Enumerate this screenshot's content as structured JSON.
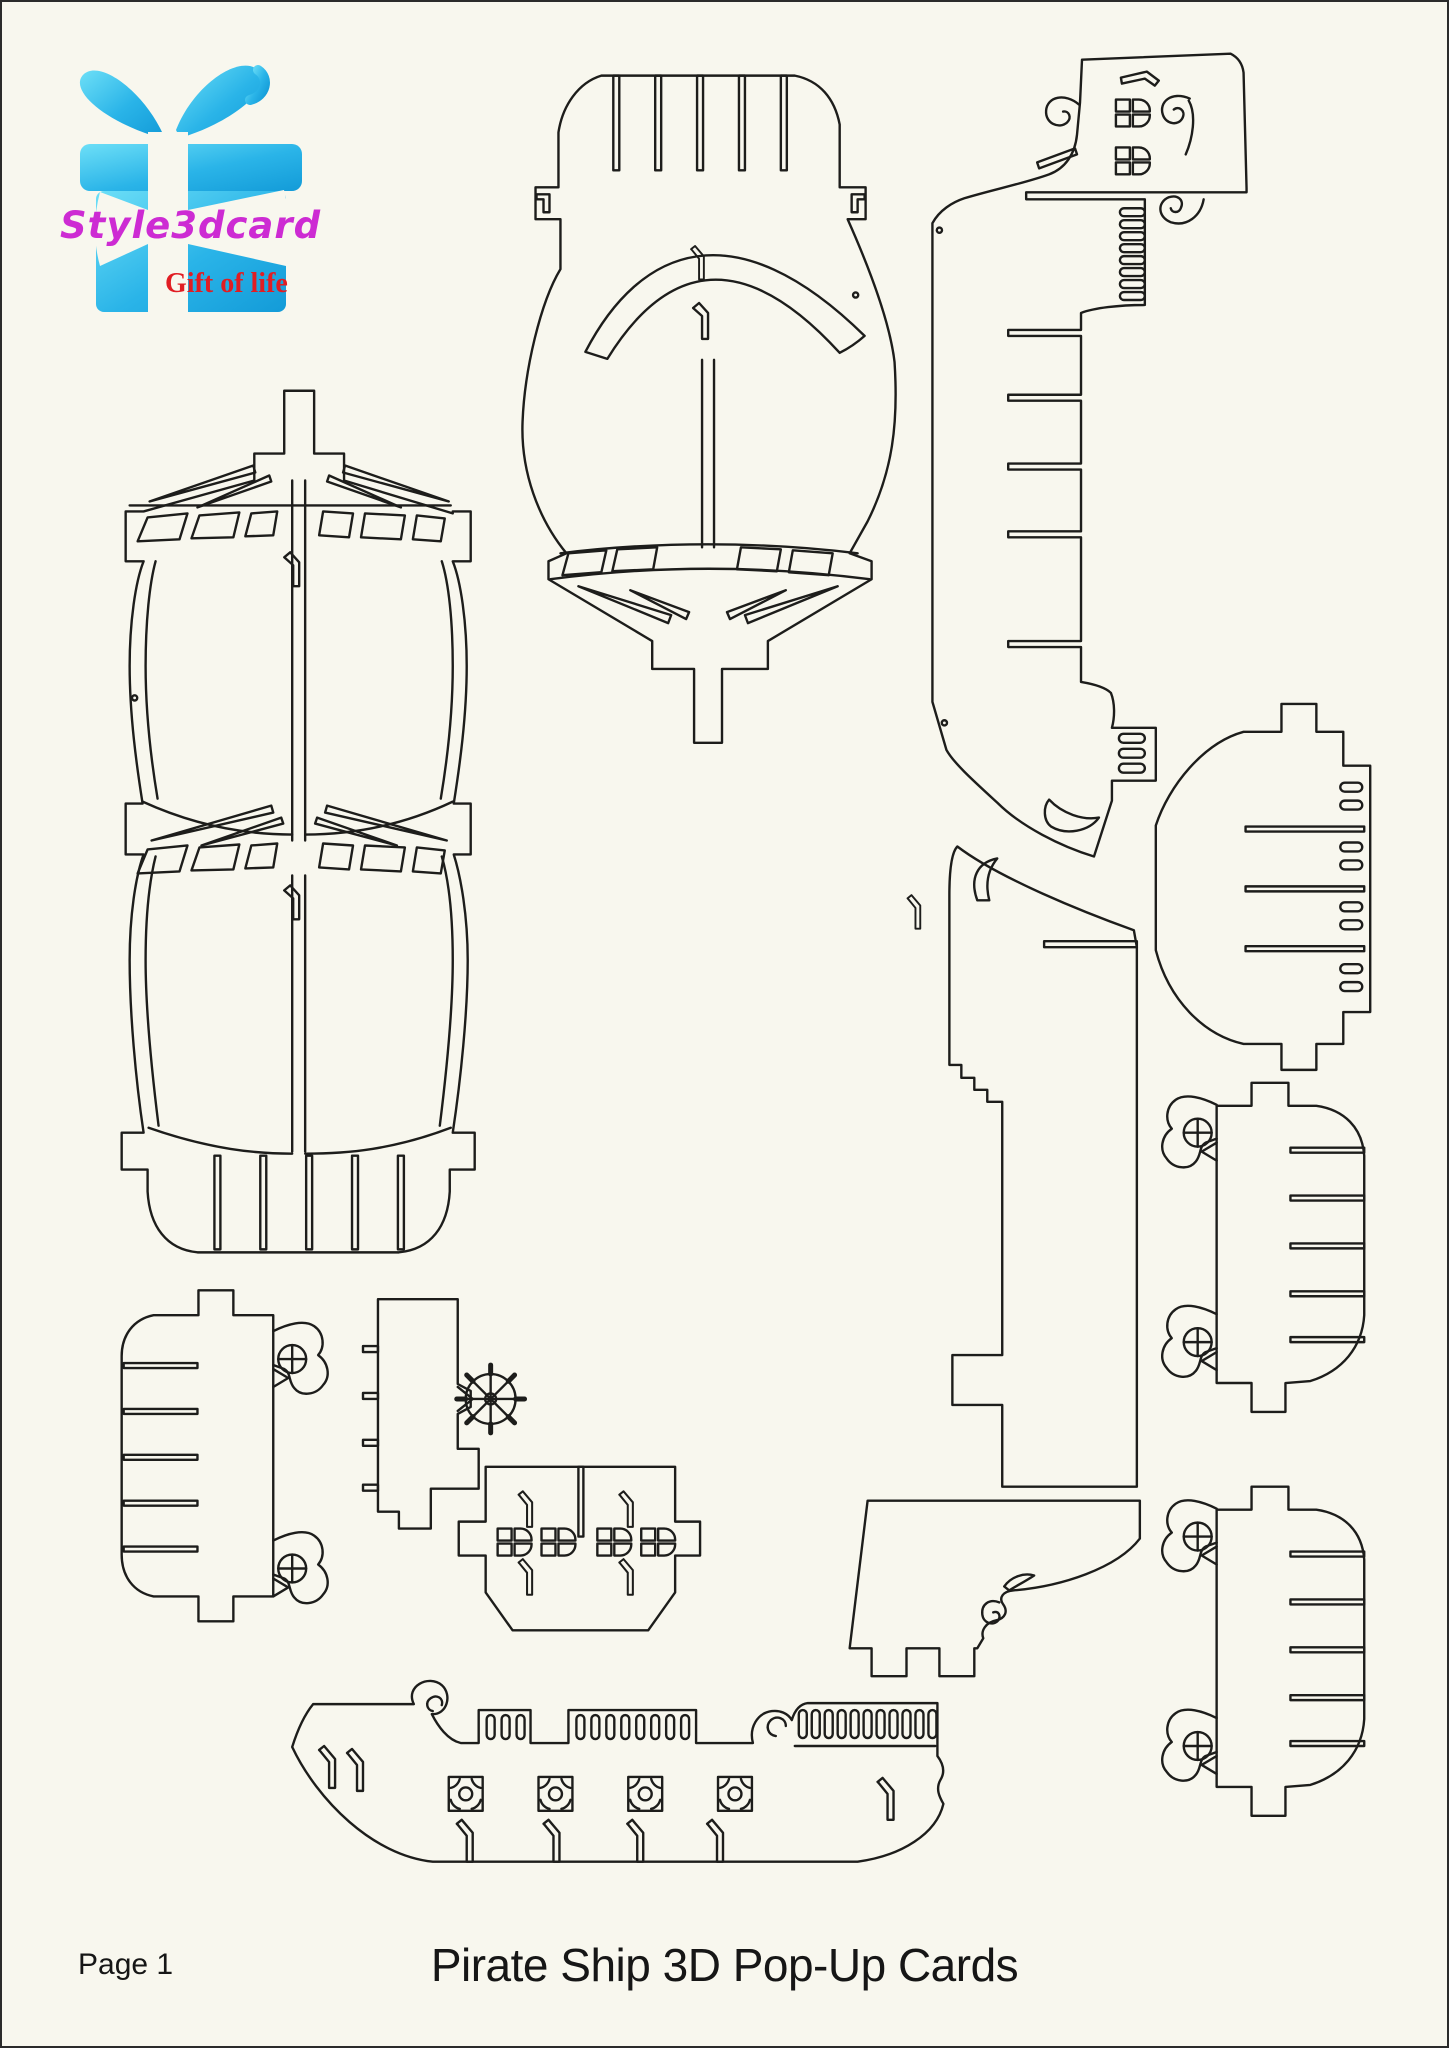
{
  "logo": {
    "brand": "Style3dcard",
    "tagline": "Gift of life"
  },
  "footer": {
    "page_label": "Page 1",
    "title": "Pirate Ship 3D Pop-Up Cards"
  },
  "colors": {
    "bg": "#f8f7ee",
    "line": "#1d1d1b",
    "magenta": "#cd2bd3",
    "red": "#e11d23",
    "cyan": "#2ab4e8",
    "cyan-light": "#66dcf6",
    "cyan-dark": "#139bd8",
    "text": "#161616"
  },
  "pieces": [
    {
      "id": "sail-fore",
      "label": "Fore sail panel with slot comb and mast cross"
    },
    {
      "id": "sail-main-double",
      "label": "Double main sail panel with mast cross and base comb"
    },
    {
      "id": "stern-castle-side",
      "label": "Stern castle side with windows, scrolls and tab slots"
    },
    {
      "id": "hull-profile-strip",
      "label": "Long hull profile strip with stair notches"
    },
    {
      "id": "bow-quarter-panel",
      "label": "Bow quarter panel with wave scrolls and tabs"
    },
    {
      "id": "deck-panel",
      "label": "Deck panel with finger joints and oval slots"
    },
    {
      "id": "gun-deck-right-upper",
      "label": "Gun deck side, cannons left, comb right (upper)"
    },
    {
      "id": "gun-deck-right-lower",
      "label": "Gun deck side, cannons left, comb right (lower)"
    },
    {
      "id": "gun-deck-left",
      "label": "Gun deck side, comb left, cannons right"
    },
    {
      "id": "keel-strip-wheel",
      "label": "Keel strip with ship helm wheel"
    },
    {
      "id": "cabin-window-panel",
      "label": "Cabin panel with four windows"
    },
    {
      "id": "hull-side-railing",
      "label": "Hull side profile with railings, scrolls and gun ports"
    }
  ]
}
